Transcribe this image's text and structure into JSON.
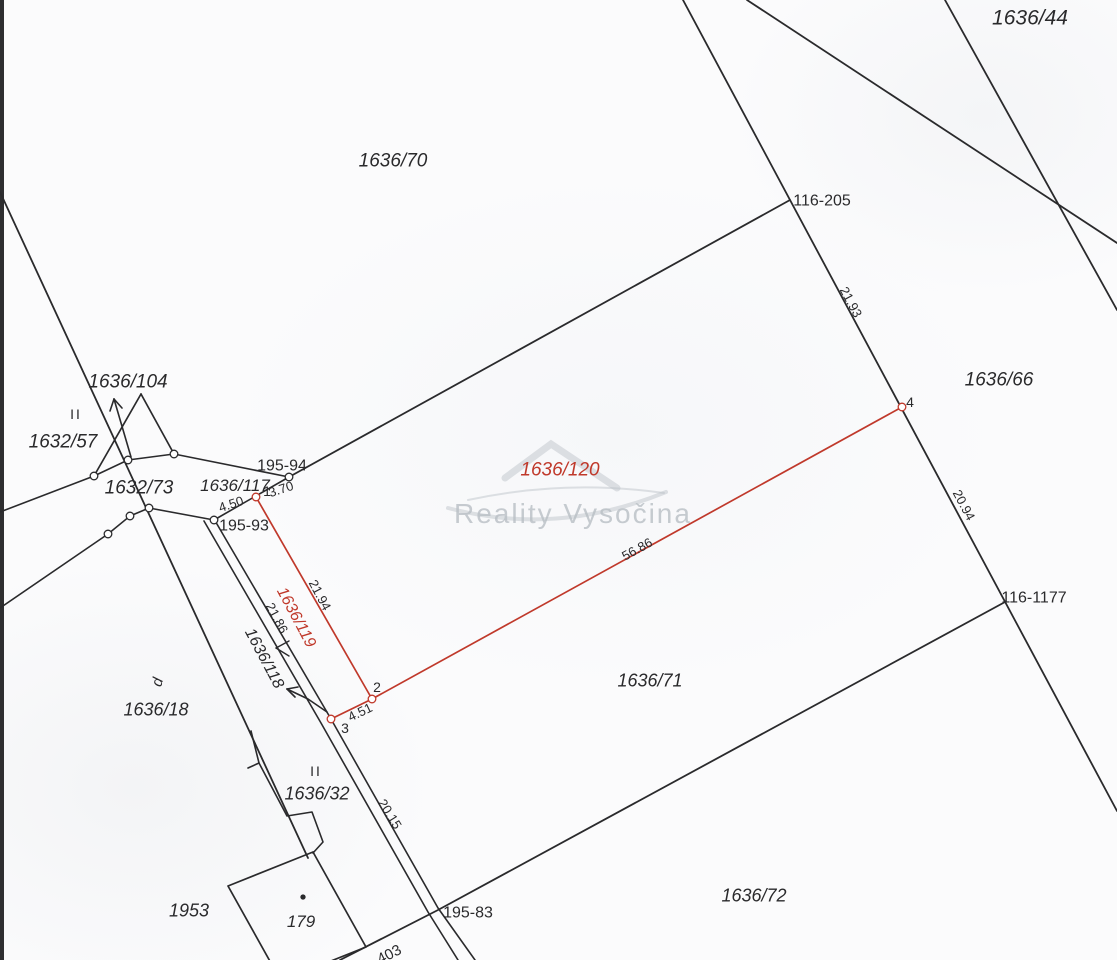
{
  "map": {
    "title": "cadastral parcel map scan",
    "colors": {
      "ink": "#2a2a2c",
      "red": "#c0392b",
      "wm": "#b9bfc5"
    },
    "watermark": {
      "text": "Reality Vysočina",
      "x": 573,
      "y": 513,
      "size": 28,
      "letter_spacing": 2,
      "paths": [
        {
          "d": "M 505 478 L 551 444 L 617 488",
          "w": 7
        },
        {
          "d": "M 468 500 Q 565 479 664 493",
          "w": 2
        },
        {
          "d": "M 448 508 Q 556 537 666 492",
          "w": 4
        }
      ],
      "opacity": 0.45
    },
    "lines": [
      {
        "n": "boundary-ne-long",
        "pts": [
          [
            683,
            0
          ],
          [
            1117,
            811
          ]
        ],
        "w": 1.8
      },
      {
        "n": "boundary-1636-44-west",
        "pts": [
          [
            945,
            0
          ],
          [
            1117,
            310
          ]
        ],
        "w": 1.8
      },
      {
        "n": "boundary-1636-44-south",
        "pts": [
          [
            747,
            0
          ],
          [
            1117,
            243
          ]
        ],
        "w": 1.8
      },
      {
        "n": "boundary-1636-71-north",
        "pts": [
          [
            790,
            200
          ],
          [
            289,
            477
          ]
        ],
        "w": 1.8
      },
      {
        "n": "boundary-1636-71-72",
        "pts": [
          [
            1005,
            602
          ],
          [
            438,
            910
          ],
          [
            340,
            960
          ]
        ],
        "w": 1.8
      },
      {
        "n": "boundary-west-long",
        "pts": [
          [
            0,
            192
          ],
          [
            308,
            858
          ]
        ],
        "w": 1.8
      },
      {
        "n": "triangle-1636-104-left",
        "pts": [
          [
            141,
            394
          ],
          [
            94,
            476
          ]
        ],
        "w": 1.7
      },
      {
        "n": "triangle-1636-104-right",
        "pts": [
          [
            141,
            394
          ],
          [
            174,
            454
          ]
        ],
        "w": 1.7
      },
      {
        "n": "boundary-chain-north",
        "pts": [
          [
            0,
            512
          ],
          [
            94,
            476
          ],
          [
            128,
            460
          ],
          [
            174,
            454
          ]
        ],
        "w": 1.6
      },
      {
        "n": "boundary-1636-117-top",
        "pts": [
          [
            174,
            454
          ],
          [
            289,
            477
          ]
        ],
        "w": 1.6
      },
      {
        "n": "segment-19593-19594",
        "pts": [
          [
            214,
            520
          ],
          [
            289,
            477
          ]
        ],
        "w": 1.6
      },
      {
        "n": "boundary-chain-south",
        "pts": [
          [
            214,
            520
          ],
          [
            149,
            508
          ],
          [
            130,
            516
          ],
          [
            108,
            534
          ],
          [
            0,
            608
          ]
        ],
        "w": 1.6
      },
      {
        "n": "road-strip-west",
        "pts": [
          [
            204,
            521
          ],
          [
            321,
            723
          ],
          [
            428,
            912
          ],
          [
            458,
            960
          ]
        ],
        "w": 1.6
      },
      {
        "n": "road-strip-east",
        "pts": [
          [
            214,
            519
          ],
          [
            331,
            719
          ],
          [
            438,
            908
          ],
          [
            475,
            960
          ]
        ],
        "w": 1.6
      },
      {
        "n": "building-step-notch",
        "pts": [
          [
            251,
            731
          ],
          [
            259,
            763
          ],
          [
            248,
            768
          ]
        ],
        "w": 1.6
      },
      {
        "n": "building-step-outline",
        "pts": [
          [
            259,
            763
          ],
          [
            287,
            816
          ],
          [
            312,
            812
          ],
          [
            323,
            842
          ],
          [
            313,
            853
          ]
        ],
        "w": 1.6
      },
      {
        "n": "building-179-outline",
        "pts": [
          [
            313,
            852
          ],
          [
            366,
            947
          ],
          [
            281,
            981
          ],
          [
            228,
            886
          ],
          [
            313,
            852
          ]
        ],
        "w": 1.7
      },
      {
        "n": "strip-tick-upper",
        "pts": [
          [
            289,
            641
          ],
          [
            276,
            648
          ]
        ],
        "w": 1.4
      },
      {
        "n": "strip-tick-lower",
        "pts": [
          [
            276,
            648
          ],
          [
            289,
            656
          ]
        ],
        "w": 1.4
      },
      {
        "n": "north-arrow-shaft",
        "pts": [
          [
            131,
            457
          ],
          [
            114,
            399
          ]
        ],
        "w": 1.6
      },
      {
        "n": "north-arrow-head-l",
        "pts": [
          [
            114,
            399
          ],
          [
            110,
            411
          ]
        ],
        "w": 1.6
      },
      {
        "n": "north-arrow-head-r",
        "pts": [
          [
            114,
            399
          ],
          [
            122,
            408
          ]
        ],
        "w": 1.6
      },
      {
        "n": "label-arrow-1636-118",
        "pts": [
          [
            327,
            712
          ],
          [
            308,
            699
          ],
          [
            287,
            689
          ]
        ],
        "w": 1.6
      },
      {
        "n": "label-arrow-head-a",
        "pts": [
          [
            287,
            689
          ],
          [
            298,
            687
          ]
        ],
        "w": 1.6
      },
      {
        "n": "label-arrow-head-b",
        "pts": [
          [
            287,
            689
          ],
          [
            295,
            697
          ]
        ],
        "w": 1.6
      },
      {
        "n": "parcel-1636-119-side-12",
        "pts": [
          [
            256,
            497
          ],
          [
            372,
            699
          ]
        ],
        "c": "red",
        "w": 1.7
      },
      {
        "n": "parcel-1636-119-side-23",
        "pts": [
          [
            372,
            699
          ],
          [
            331,
            719
          ]
        ],
        "c": "red",
        "w": 1.7
      },
      {
        "n": "parcel-1636-120-side-24",
        "pts": [
          [
            372,
            699
          ],
          [
            902,
            407
          ]
        ],
        "c": "red",
        "w": 1.7
      }
    ],
    "points": [
      {
        "n": "survey-point-195-94",
        "x": 289,
        "y": 477
      },
      {
        "n": "survey-point-195-93",
        "x": 214,
        "y": 520
      },
      {
        "n": "survey-point-a",
        "x": 128,
        "y": 460
      },
      {
        "n": "survey-point-b",
        "x": 174,
        "y": 454
      },
      {
        "n": "survey-point-c",
        "x": 94,
        "y": 476
      },
      {
        "n": "survey-point-d",
        "x": 149,
        "y": 508
      },
      {
        "n": "survey-point-e",
        "x": 130,
        "y": 516
      },
      {
        "n": "survey-point-f",
        "x": 108,
        "y": 534
      },
      {
        "n": "vertex-1",
        "x": 256,
        "y": 497,
        "c": "red"
      },
      {
        "n": "vertex-2",
        "x": 372,
        "y": 699,
        "c": "red"
      },
      {
        "n": "vertex-3",
        "x": 331,
        "y": 719,
        "c": "red"
      },
      {
        "n": "vertex-4",
        "x": 902,
        "y": 407,
        "c": "red"
      },
      {
        "n": "building-179-dot",
        "x": 303,
        "y": 897,
        "r": 2,
        "f": true
      }
    ],
    "labels": [
      {
        "n": "parcel-label-1636-44",
        "t": "1636/44",
        "x": 1030,
        "y": 17,
        "s": 21,
        "i": true
      },
      {
        "n": "parcel-label-1636-70",
        "t": "1636/70",
        "x": 393,
        "y": 160,
        "s": 19,
        "i": true
      },
      {
        "n": "parcel-label-1636-66",
        "t": "1636/66",
        "x": 999,
        "y": 379,
        "s": 19,
        "i": true
      },
      {
        "n": "parcel-label-1636-104",
        "t": "1636/104",
        "x": 128,
        "y": 381,
        "s": 19,
        "i": true
      },
      {
        "n": "parcel-label-1632-57",
        "t": "1632/57",
        "x": 63,
        "y": 441,
        "s": 19,
        "i": true
      },
      {
        "n": "parcel-label-1632-73",
        "t": "1632/73",
        "x": 139,
        "y": 487,
        "s": 19,
        "i": true
      },
      {
        "n": "parcel-label-1636-117",
        "t": "1636/117",
        "x": 235,
        "y": 485,
        "s": 17,
        "i": true
      },
      {
        "n": "parcel-label-1636-71",
        "t": "1636/71",
        "x": 650,
        "y": 680,
        "s": 18,
        "i": true
      },
      {
        "n": "parcel-label-1636-18",
        "t": "1636/18",
        "x": 156,
        "y": 709,
        "s": 18,
        "i": true
      },
      {
        "n": "parcel-label-1636-32",
        "t": "1636/32",
        "x": 317,
        "y": 793,
        "s": 18,
        "i": true
      },
      {
        "n": "parcel-label-1953",
        "t": "1953",
        "x": 189,
        "y": 910,
        "s": 18,
        "i": true
      },
      {
        "n": "parcel-label-179",
        "t": "179",
        "x": 301,
        "y": 921,
        "s": 17,
        "i": true
      },
      {
        "n": "parcel-label-1636-72",
        "t": "1636/72",
        "x": 754,
        "y": 895,
        "s": 18,
        "i": true
      },
      {
        "n": "parcel-label-1636-118",
        "t": "1636/118",
        "x": 265,
        "y": 658,
        "s": 16,
        "i": true,
        "r": 62
      },
      {
        "n": "parcel-label-1636-119",
        "t": "1636/119",
        "x": 297,
        "y": 617,
        "s": 16,
        "i": true,
        "r": 62,
        "c": "red"
      },
      {
        "n": "parcel-label-1636-120",
        "t": "1636/120",
        "x": 560,
        "y": 469,
        "s": 19,
        "i": true,
        "c": "red"
      },
      {
        "n": "point-label-116-205",
        "t": "116-205",
        "x": 822,
        "y": 200,
        "s": 16
      },
      {
        "n": "point-label-116-1177",
        "t": "116-1177",
        "x": 1034,
        "y": 597,
        "s": 16
      },
      {
        "n": "point-label-195-94",
        "t": "195-94",
        "x": 282,
        "y": 465,
        "s": 16
      },
      {
        "n": "point-label-195-93",
        "t": "195-93",
        "x": 244,
        "y": 525,
        "s": 16
      },
      {
        "n": "point-label-195-83",
        "t": "195-83",
        "x": 468,
        "y": 912,
        "s": 16
      },
      {
        "n": "point-label-partial-403",
        "t": "403",
        "x": 389,
        "y": 954,
        "s": 15,
        "r": -27
      },
      {
        "n": "vertex-label-1",
        "t": "1",
        "x": 267,
        "y": 491,
        "s": 14
      },
      {
        "n": "vertex-label-2",
        "t": "2",
        "x": 377,
        "y": 687,
        "s": 14
      },
      {
        "n": "vertex-label-3",
        "t": "3",
        "x": 345,
        "y": 728,
        "s": 14
      },
      {
        "n": "vertex-label-4",
        "t": "4",
        "x": 910,
        "y": 402,
        "s": 14
      },
      {
        "n": "measure-21-93",
        "t": "21.93",
        "x": 851,
        "y": 302,
        "s": 13,
        "r": 62
      },
      {
        "n": "measure-20-94",
        "t": "20.94",
        "x": 964,
        "y": 505,
        "s": 13,
        "r": 62
      },
      {
        "n": "measure-4-50",
        "t": "4.50",
        "x": 231,
        "y": 504,
        "s": 13,
        "r": -18
      },
      {
        "n": "measure-3-70",
        "t": "3.70",
        "x": 281,
        "y": 489,
        "s": 13,
        "r": -18
      },
      {
        "n": "measure-21-94",
        "t": "21.94",
        "x": 320,
        "y": 595,
        "s": 13,
        "r": 62
      },
      {
        "n": "measure-21-86",
        "t": "21.86",
        "x": 277,
        "y": 618,
        "s": 13,
        "r": 62
      },
      {
        "n": "measure-4-51",
        "t": "4.51",
        "x": 360,
        "y": 712,
        "s": 13,
        "r": -26
      },
      {
        "n": "measure-56-86",
        "t": "56.86",
        "x": 637,
        "y": 549,
        "s": 13,
        "r": -29
      },
      {
        "n": "measure-20-15",
        "t": "20.15",
        "x": 390,
        "y": 814,
        "s": 13,
        "r": 58
      },
      {
        "n": "symbol-II-west",
        "t": "II",
        "x": 76,
        "y": 414,
        "s": 14,
        "ls": 2
      },
      {
        "n": "symbol-II-south",
        "t": "II",
        "x": 316,
        "y": 771,
        "s": 14,
        "ls": 2
      },
      {
        "n": "symbol-landuse-d",
        "t": "d",
        "x": 157,
        "y": 682,
        "s": 15,
        "i": true,
        "r": -75
      }
    ]
  }
}
